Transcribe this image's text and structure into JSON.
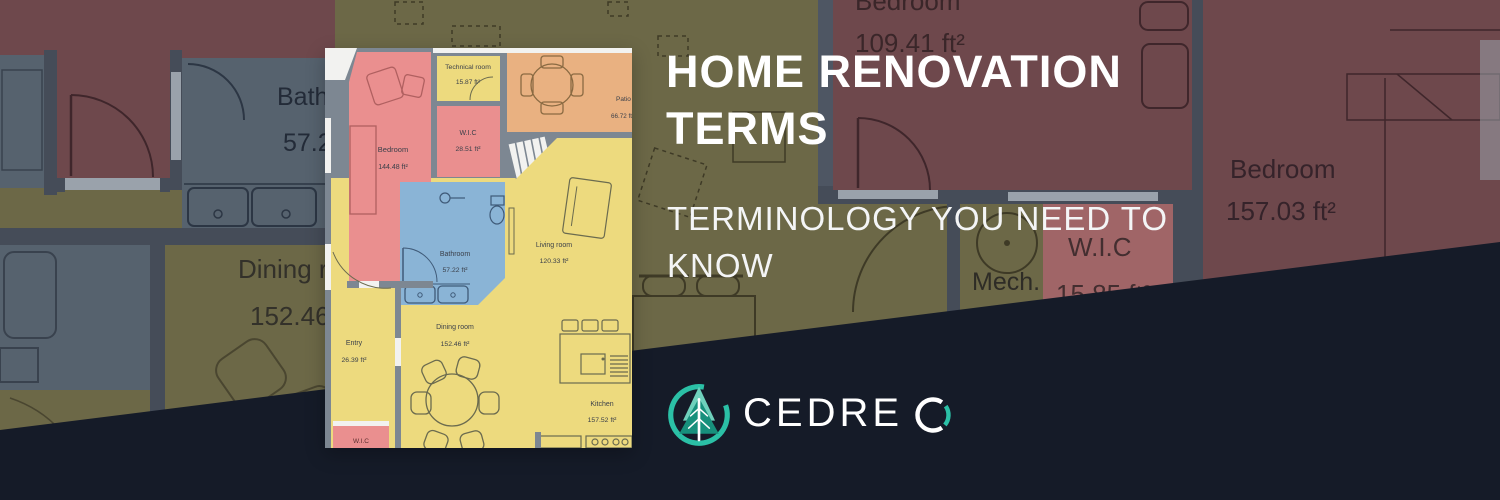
{
  "header": {
    "title_lines": [
      "HOME RENOVATION",
      "TERMS"
    ],
    "subtitle_lines": [
      "TERMINOLOGY YOU NEED TO",
      "KNOW"
    ]
  },
  "logo": {
    "name": "CEDREO",
    "text_main": "CEDRE",
    "text_last_letter": "O"
  },
  "card_plan": {
    "rooms": [
      {
        "name": "Bedroom",
        "area": "144.48 ft²"
      },
      {
        "name": "Technical room",
        "area": "15.87 ft²"
      },
      {
        "name": "W.I.C",
        "area": "28.51 ft²"
      },
      {
        "name": "Patio",
        "area": "66.72 ft²"
      },
      {
        "name": "Bathroom",
        "area": "57.22 ft²"
      },
      {
        "name": "Living room",
        "area": "120.33 ft²"
      },
      {
        "name": "Dining room",
        "area": "152.46 ft²"
      },
      {
        "name": "Entry",
        "area": "26.39 ft²"
      },
      {
        "name": "Kitchen",
        "area": "157.52 ft²"
      },
      {
        "name": "W.I.C",
        "area": ""
      }
    ]
  },
  "background_plan": {
    "labels": {
      "bathroom_name": "Bathroom",
      "bathroom_area": "57.22 ft²",
      "dining_name": "Dining room",
      "dining_area": "152.46 ft²",
      "bedroom_top_name": "Bedroom",
      "bedroom_top_area": "109.41 ft²",
      "mech_name": "Mech.",
      "wic_name": "W.I.C",
      "wic_area": "15.85 ft²",
      "bedroom_right_name": "Bedroom",
      "bedroom_right_area": "157.03 ft²"
    }
  },
  "colors": {
    "accent_teal": "#2BC0A6",
    "wedge_navy": "#151B28",
    "bg_olive": "#6C6847",
    "bg_maroon": "#6E484C",
    "bg_bluegrey": "#56626E",
    "bg_wall": "#454C58",
    "bg_wic_red": "#A06567",
    "card_red": "#EA8F8F",
    "card_yellow": "#EDDA7E",
    "card_orange": "#E9B181",
    "card_blue": "#8AB4D6",
    "card_wall": "#7D8792"
  }
}
